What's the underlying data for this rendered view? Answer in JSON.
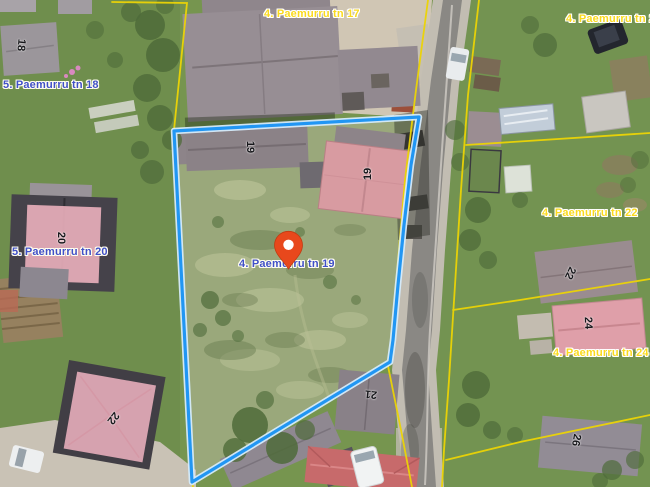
{
  "map": {
    "address_labels": [
      {
        "text": "4. Paemurru tn 17",
        "style": "yellow"
      },
      {
        "text": "4. Paemurru tn 20",
        "style": "yellow"
      },
      {
        "text": "5. Paemurru tn 18",
        "style": "blue"
      },
      {
        "text": "5. Paemurru tn 20",
        "style": "blue"
      },
      {
        "text": "4. Paemurru tn 19",
        "style": "blue"
      },
      {
        "text": "4. Paemurru tn 22",
        "style": "yellow"
      },
      {
        "text": "4. Paemurru tn 24",
        "style": "yellow"
      }
    ],
    "building_numbers": [
      "18",
      "19",
      "19",
      "20",
      "22",
      "21",
      "22",
      "24",
      "26"
    ],
    "selected_parcel": {
      "label": "4. Paemurru tn 19"
    },
    "colors": {
      "parcel_outline": "#2196f3",
      "cadastral_line": "#ecd405",
      "marker": "#e8481c",
      "label_yellow": "#fada1e",
      "label_blue": "#4050c8"
    }
  }
}
